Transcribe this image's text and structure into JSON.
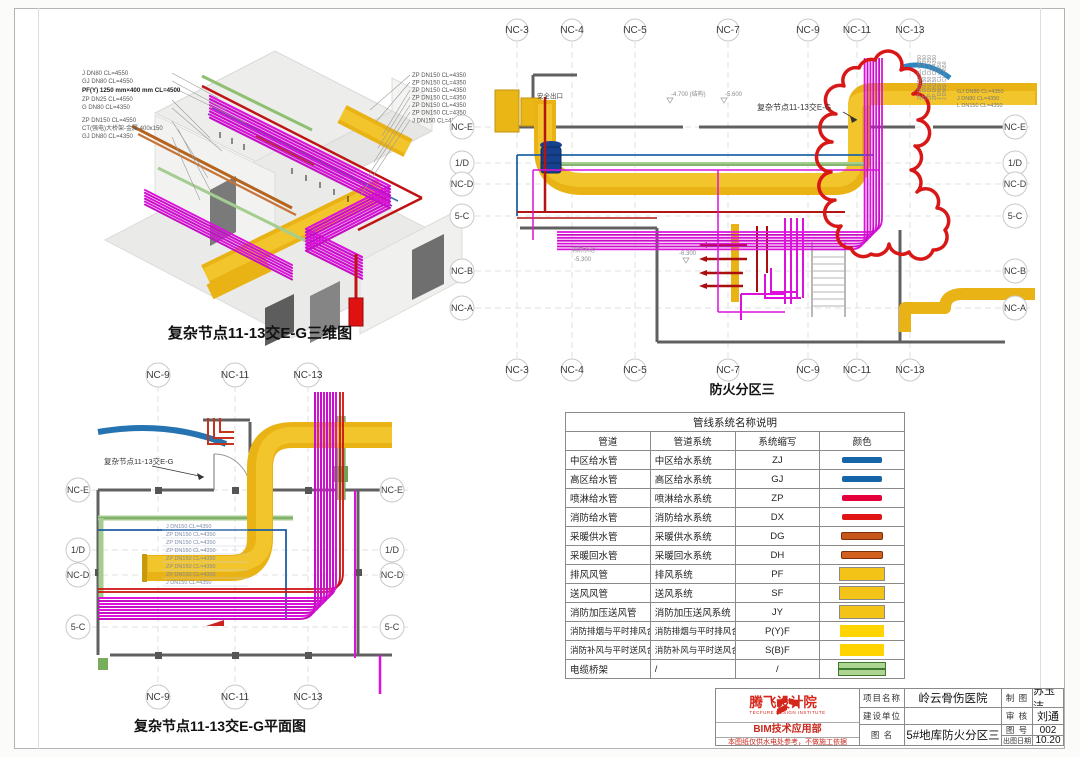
{
  "view3d": {
    "title": "复杂节点11-13交E-G三维图",
    "left_labels": [
      "J DN80 CL=4550",
      "GJ DN80 CL=4550",
      "PF(Y) 1250 mm×400 mm CL=4500",
      "ZP DN25 CL=4550",
      "G DN80 CL=4350",
      "ZP DN150 CL=4550",
      "CT(强电)大桥架-金属 400x150",
      "GJ DN80 CL=4350"
    ],
    "right_labels": [
      "ZP DN150 CL=4350",
      "ZP DN150 CL=4350",
      "ZP DN150 CL=4350",
      "ZP DN150 CL=4350",
      "ZP DN150 CL=4350",
      "ZP DN150 CL=4350",
      "J DN150 CL=4350"
    ]
  },
  "plan_top": {
    "title": "防火分区三",
    "cols": [
      "NC-3",
      "NC-4",
      "NC-5",
      "NC-7",
      "NC-9",
      "NC-11",
      "NC-13"
    ],
    "rows": [
      "NC-E",
      "1/D",
      "NC-D",
      "5-C",
      "NC-B",
      "NC-A"
    ],
    "node_label": "复杂节点11-13交E-G",
    "exit_label": "安全出口",
    "elev1": "-4.700 (结构)",
    "elev2": "-5.600",
    "elev3": "-6.300",
    "pool_label": "消防水池",
    "pool_elev": "-5.300",
    "right_tags": [
      "GJ DN80 CL=4350",
      "J DN80 CL=4350",
      "L DN150 CL=4350"
    ],
    "vert_tags": [
      "ZP DN150 CL=4350",
      "ZP DN150 CL=4350",
      "ZP DN150 CL=4350",
      "ZP DN150 CL=4350",
      "J DN80 CL=4350",
      "J DN80 CL=4550"
    ]
  },
  "plan_bl": {
    "title": "复杂节点11-13交E-G平面图",
    "cols": [
      "NC-9",
      "NC-11",
      "NC-13"
    ],
    "rows": [
      "NC-E",
      "1/D",
      "NC-D",
      "5-C"
    ],
    "node_label": "复杂节点11-13交E-G",
    "pipe_tags": [
      "J DN150 CL=4350",
      "ZP DN150 CL=4350",
      "ZP DN150 CL=4350",
      "ZP DN150 CL=4350",
      "ZP DN150 CL=4350",
      "ZP DN150 CL=4350",
      "ZP DN150 CL=4350",
      "J DN150 CL=4350"
    ]
  },
  "legend": {
    "title": "管线系统名称说明",
    "headers": [
      "管道",
      "管道系统",
      "系统缩写",
      "颜色"
    ],
    "rows": [
      {
        "pipe": "中区给水管",
        "system": "中区给水系统",
        "code": "ZJ",
        "swatch": {
          "kind": "bar",
          "color": "#1565a8",
          "border": "none"
        }
      },
      {
        "pipe": "高区给水管",
        "system": "高区给水系统",
        "code": "GJ",
        "swatch": {
          "kind": "bar",
          "color": "#1565a8",
          "border": "none"
        }
      },
      {
        "pipe": "喷淋给水管",
        "system": "喷淋给水系统",
        "code": "ZP",
        "swatch": {
          "kind": "bar",
          "color": "#e4003a",
          "border": "none"
        }
      },
      {
        "pipe": "消防给水管",
        "system": "消防给水系统",
        "code": "DX",
        "swatch": {
          "kind": "bar",
          "color": "#e01616",
          "border": "none"
        }
      },
      {
        "pipe": "采暖供水管",
        "system": "采暖供水系统",
        "code": "DG",
        "swatch": {
          "kind": "bar",
          "color": "#c8551a",
          "border": "#7a3008"
        }
      },
      {
        "pipe": "采暖回水管",
        "system": "采暖回水系统",
        "code": "DH",
        "swatch": {
          "kind": "bar",
          "color": "#d2601e",
          "border": "#7a3008"
        }
      },
      {
        "pipe": "排风风管",
        "system": "排风系统",
        "code": "PF",
        "swatch": {
          "kind": "duct",
          "color": "#f3c318",
          "border": "#8a8a8a"
        }
      },
      {
        "pipe": "送风风管",
        "system": "送风系统",
        "code": "SF",
        "swatch": {
          "kind": "duct",
          "color": "#f3c318",
          "border": "#8a8a8a"
        }
      },
      {
        "pipe": "消防加压送风管",
        "system": "消防加压送风系统",
        "code": "JY",
        "swatch": {
          "kind": "duct",
          "color": "#f3c318",
          "border": "#8a8a8a"
        }
      },
      {
        "pipe": "消防排烟与平时排风合用风管",
        "system": "消防排烟与平时排风合用系统",
        "code": "P(Y)F",
        "swatch": {
          "kind": "duct",
          "color": "#ffd400",
          "border": "none"
        }
      },
      {
        "pipe": "消防补风与平时送风合用风管",
        "system": "消防补风与平时送风合用系统",
        "code": "S(B)F",
        "swatch": {
          "kind": "duct",
          "color": "#ffd400",
          "border": "none"
        }
      },
      {
        "pipe": "电缆桥架",
        "system": "/",
        "code": "/",
        "swatch": {
          "kind": "tray",
          "color": "#aed492",
          "border": "#3e7a2e"
        }
      }
    ]
  },
  "title_block": {
    "company": "腾飞设计院",
    "company_en": "TECFURE DESIGN INSTITUTE",
    "department": "BIM技术应用部",
    "disclaimer": "本图纸仅供水电处参考，不做施工依据",
    "project_label": "项目名称",
    "project_value": "岭云骨伤医院",
    "client_label": "建设单位",
    "client_value": "",
    "drawing_label": "图  名",
    "drawing_value": "5#地库防火分区三",
    "draft_label": "制 图",
    "draft_value": "苏玉洁",
    "review_label": "审 核",
    "review_value": "刘通",
    "no_label": "图 号",
    "no_value": "002",
    "date_label": "出图日期",
    "date_value": "10.20"
  }
}
